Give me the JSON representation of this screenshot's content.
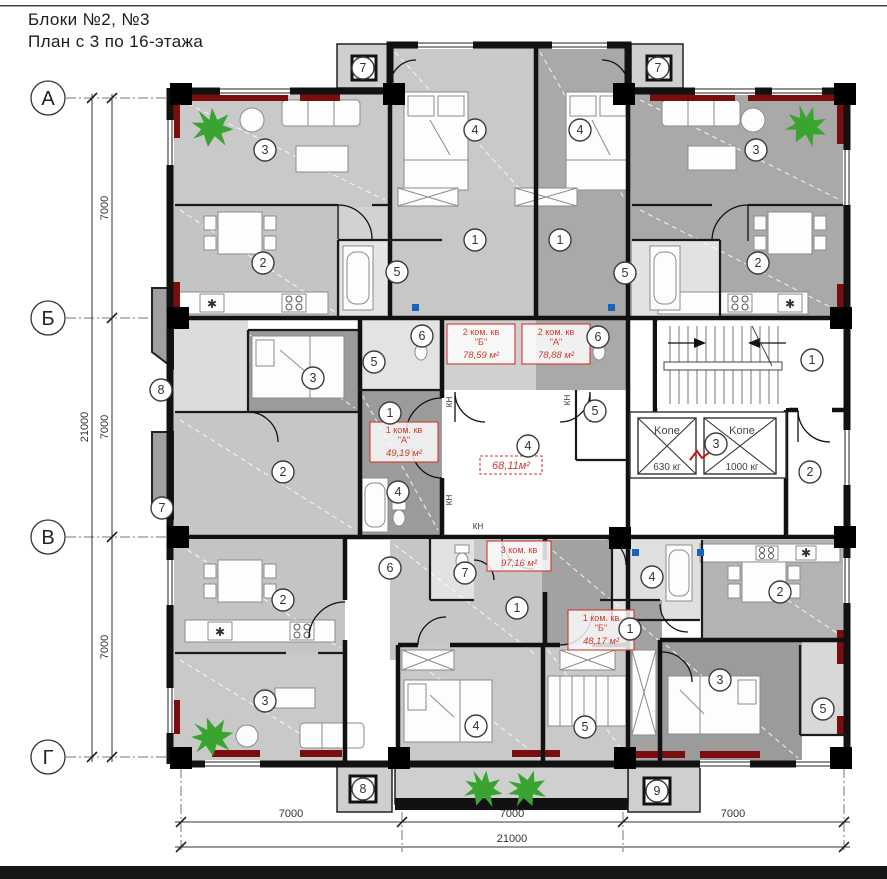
{
  "title": {
    "line1": "Блоки  №2, №3",
    "line2": "План с 3 по 16-этажа"
  },
  "axes": {
    "rows": [
      "А",
      "Б",
      "В",
      "Г"
    ]
  },
  "dimensions": {
    "span": "7000",
    "total": "21000"
  },
  "apartments": [
    {
      "name": "2 ком. кв",
      "unit": "\"Б\"",
      "area": "78,59 м²"
    },
    {
      "name": "2 ком. кв",
      "unit": "\"А\"",
      "area": "78,88 м²"
    },
    {
      "name": "1 ком. кв",
      "unit": "\"А\"",
      "area": "49,19 м²"
    },
    {
      "name": "3 ком. кв",
      "unit": "",
      "area": "97,16 м²"
    },
    {
      "name": "1 ком. кв",
      "unit": "\"Б\"",
      "area": "48,17 м²"
    }
  ],
  "corridor": {
    "area": "68,11м²"
  },
  "elevators": [
    {
      "brand": "Kone",
      "capacity": "630 кг"
    },
    {
      "brand": "Kone",
      "capacity": "1000 кг"
    }
  ],
  "labels": {
    "kn": "КН",
    "hob": "✱"
  },
  "colors": {
    "accent_red": "#7a0e0e",
    "label_red": "#cf3a2e",
    "plant_green": "#3aa430",
    "socket_blue": "#1465c0"
  },
  "markers": [
    "7",
    "7",
    "4",
    "4",
    "3",
    "3",
    "1",
    "1",
    "2",
    "2",
    "5",
    "5",
    "6",
    "6",
    "5",
    "8",
    "3",
    "1",
    "5",
    "2",
    "4",
    "4",
    "1",
    "2",
    "3",
    "7",
    "6",
    "7",
    "4",
    "1",
    "1",
    "2",
    "2",
    "3",
    "3",
    "4",
    "5",
    "5",
    "8",
    "9"
  ]
}
